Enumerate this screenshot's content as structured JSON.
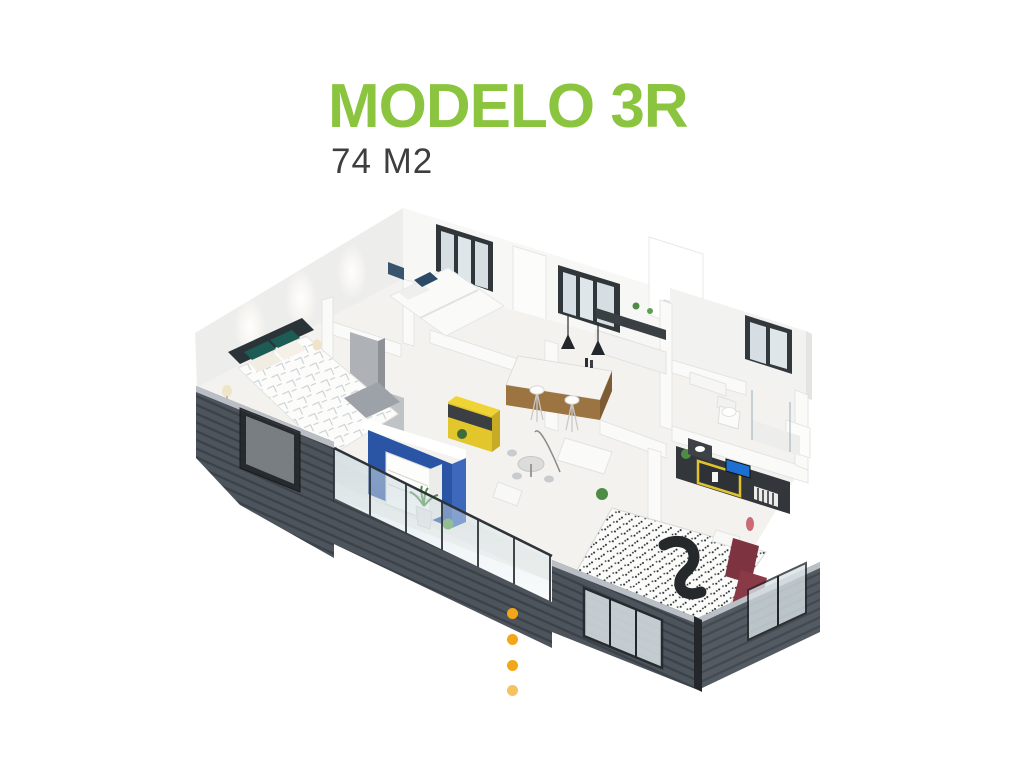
{
  "page": {
    "background_color": "#FFFFFF"
  },
  "header": {
    "title": "MODELO 3R",
    "subtitle": "74 M2",
    "title_color": "#8BC53F",
    "subtitle_color": "#3E3E3E"
  },
  "carousel": {
    "visible_dots": 4,
    "dot_color": "#F2A71B",
    "orientation": "vertical"
  },
  "floor_plan": {
    "kind": "isometric 3D apartment cutaway render",
    "rooms": [
      "master-bedroom",
      "bedroom-2",
      "kitchen",
      "living-dining",
      "balcony",
      "bathroom",
      "bedroom-3"
    ],
    "colors": {
      "exterior_wall": "#4D545B",
      "exterior_wall_stripe": "#3A4148",
      "wall_cap": "#B9BFC4",
      "interior_wall": "#FAFAF9",
      "floor": "#F3F2EF",
      "accent_blue": "#2A55A5",
      "accent_blue_light": "#3E68BC",
      "accent_yellow_top": "#F0D435",
      "accent_yellow": "#E3C52C",
      "accent_yellow_side": "#C7AB24",
      "wood": "#9B7442",
      "wood_dark": "#7D5C33",
      "counter_dark": "#3A3F44",
      "burgundy": "#7E3440",
      "burgundy_light": "#8A3A47",
      "teal_headboard": "#1D5B55",
      "headboard_frame": "#2A3438",
      "plant_green": "#4E8C46",
      "glass_frame": "#2E3337",
      "tv_blue": "#1D6FD1",
      "rug_squiggle": "#26292C"
    }
  }
}
